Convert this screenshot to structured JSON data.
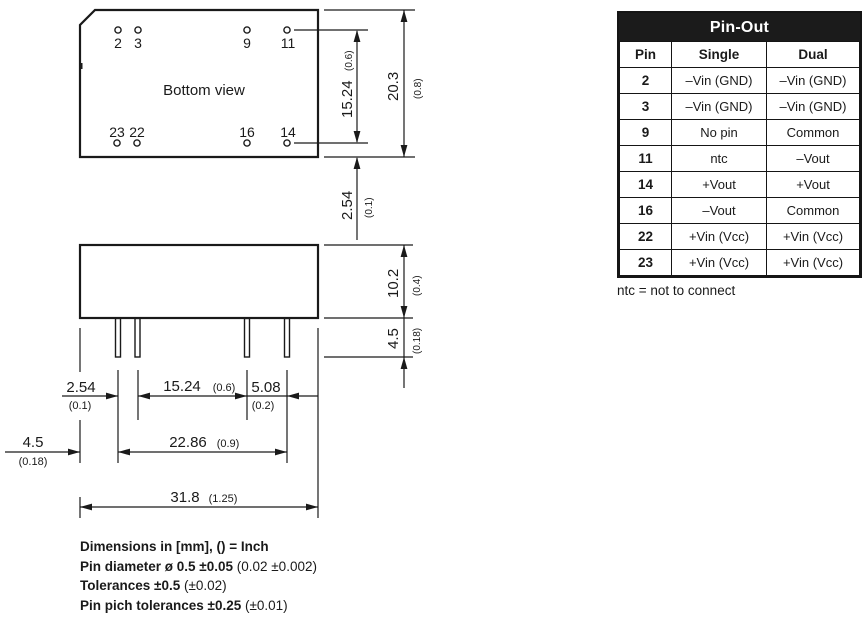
{
  "drawing": {
    "bottom_view": {
      "label": "Bottom view",
      "pin_labels_top": [
        "2",
        "3",
        "9",
        "11"
      ],
      "pin_labels_bottom": [
        "23",
        "22",
        "16",
        "14"
      ]
    },
    "dims": {
      "pin_row_spacing": {
        "mm": "15.24",
        "inch": "(0.6)"
      },
      "case_depth": {
        "mm": "20.3",
        "inch": "(0.8)"
      },
      "pin_row_to_edge": {
        "mm": "2.54",
        "inch": "(0.1)"
      },
      "case_height": {
        "mm": "10.2",
        "inch": "(0.4)"
      },
      "pin_length": {
        "mm": "4.5",
        "inch": "(0.18)"
      },
      "pitch_1": {
        "mm": "2.54",
        "inch": "(0.1)"
      },
      "pitch_2": {
        "mm": "15.24",
        "inch": "(0.6)"
      },
      "pitch_3": {
        "mm": "5.08",
        "inch": "(0.2)"
      },
      "edge_to_pin": {
        "mm": "4.5",
        "inch": "(0.18)"
      },
      "pin_span": {
        "mm": "22.86",
        "inch": "(0.9)"
      },
      "case_width": {
        "mm": "31.8",
        "inch": "(1.25)"
      }
    }
  },
  "pinout": {
    "title": "Pin-Out",
    "columns": [
      "Pin",
      "Single",
      "Dual"
    ],
    "rows": [
      {
        "pin": "2",
        "single": "–Vin (GND)",
        "dual": "–Vin (GND)"
      },
      {
        "pin": "3",
        "single": "–Vin (GND)",
        "dual": "–Vin (GND)"
      },
      {
        "pin": "9",
        "single": "No pin",
        "dual": "Common"
      },
      {
        "pin": "11",
        "single": "ntc",
        "dual": "–Vout"
      },
      {
        "pin": "14",
        "single": "+Vout",
        "dual": "+Vout"
      },
      {
        "pin": "16",
        "single": "–Vout",
        "dual": "Common"
      },
      {
        "pin": "22",
        "single": "+Vin (Vcc)",
        "dual": "+Vin (Vcc)"
      },
      {
        "pin": "23",
        "single": "+Vin (Vcc)",
        "dual": "+Vin (Vcc)"
      }
    ],
    "footnote": "ntc = not to connect"
  },
  "notes": {
    "line1": {
      "main": "Dimensions in [mm], () = Inch",
      "inch": ""
    },
    "line2": {
      "main": "Pin diameter ø 0.5 ±0.05",
      "inch": "(0.02 ±0.002)"
    },
    "line3": {
      "main": "Tolerances  ±0.5",
      "inch": "(±0.02)"
    },
    "line4": {
      "main": "Pin pich tolerances ±0.25",
      "inch": "(±0.01)"
    }
  }
}
